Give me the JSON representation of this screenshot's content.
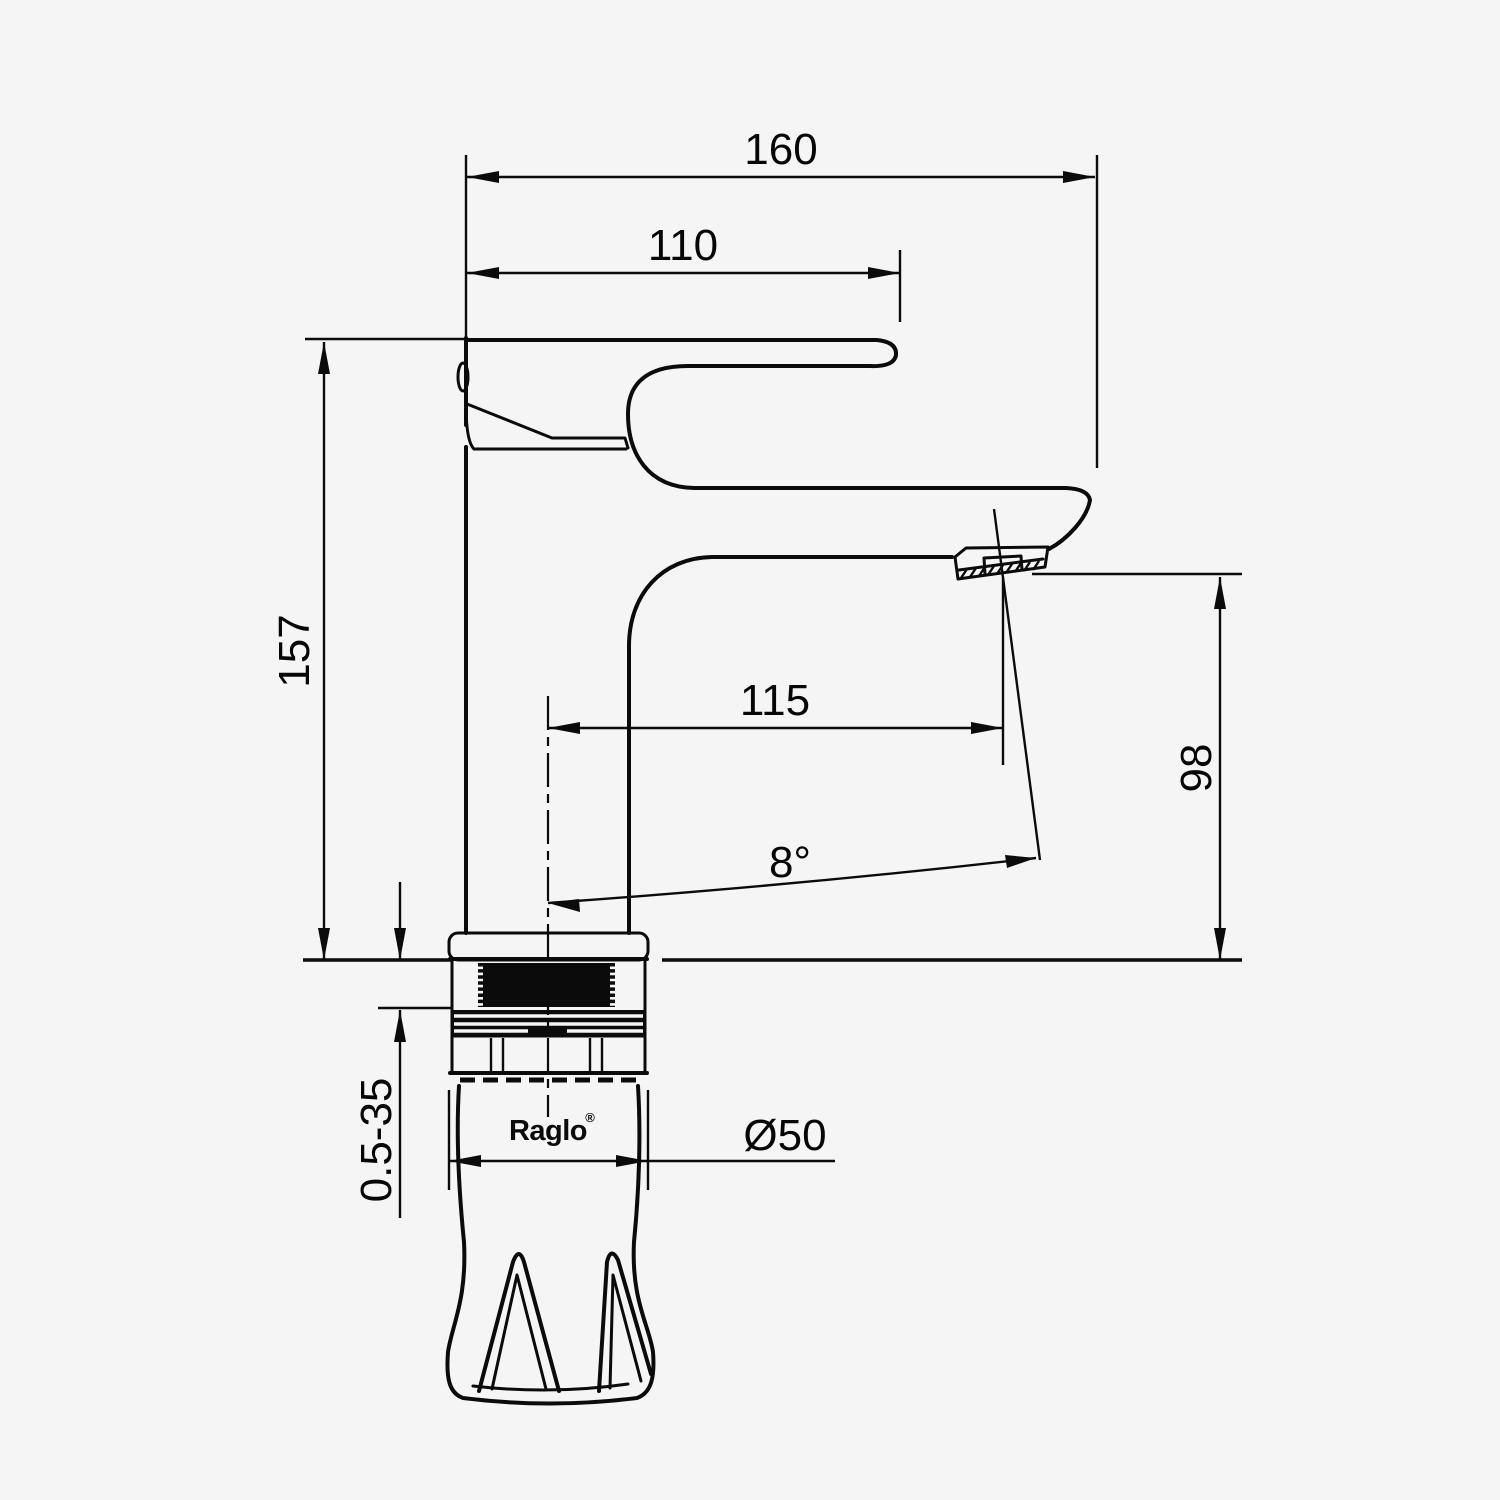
{
  "drawing": {
    "type": "technical-dimension-drawing",
    "subject": "single-lever-basin-faucet-side-view",
    "brand": {
      "name": "Raglo",
      "mark": "®"
    },
    "dimensions": {
      "overall_reach": "160",
      "handle_length": "110",
      "total_height": "157",
      "spout_reach": "115",
      "spout_height": "98",
      "spout_angle": "8°",
      "mounting_depth": "0.5-35",
      "base_diameter": "Ø50"
    },
    "colors": {
      "line": "#0b0b0b",
      "background": "#f5f5f6"
    }
  }
}
